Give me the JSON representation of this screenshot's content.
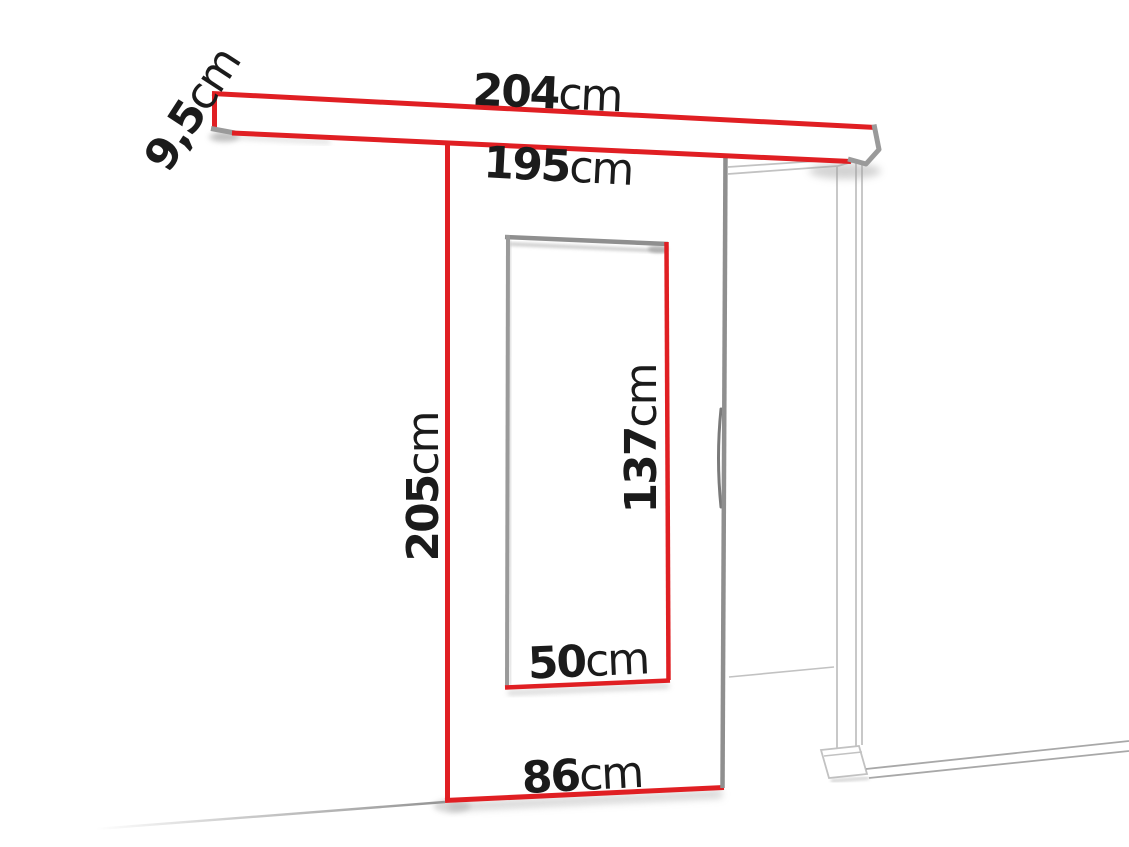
{
  "labels": {
    "rail_width": {
      "value": "204",
      "unit": "cm"
    },
    "door_top_width": {
      "value": "195",
      "unit": "cm"
    },
    "rail_height": {
      "value": "9,5",
      "unit": "cm"
    },
    "door_height": {
      "value": "205",
      "unit": "cm"
    },
    "glass_height": {
      "value": "137",
      "unit": "cm"
    },
    "glass_width": {
      "value": "50",
      "unit": "cm"
    },
    "door_bottom_width": {
      "value": "86",
      "unit": "cm"
    }
  },
  "colors": {
    "accent_red": "#e01f23",
    "edge_gray": "#8f8f8f",
    "corner_gray": "#9a9a9a",
    "frame_line_gray": "#c2c2c2",
    "floor_line_gray": "#a8a8a8",
    "shadow_gray": "#9e9e9e",
    "text_black": "#1b1b1b",
    "background": "#ffffff"
  }
}
